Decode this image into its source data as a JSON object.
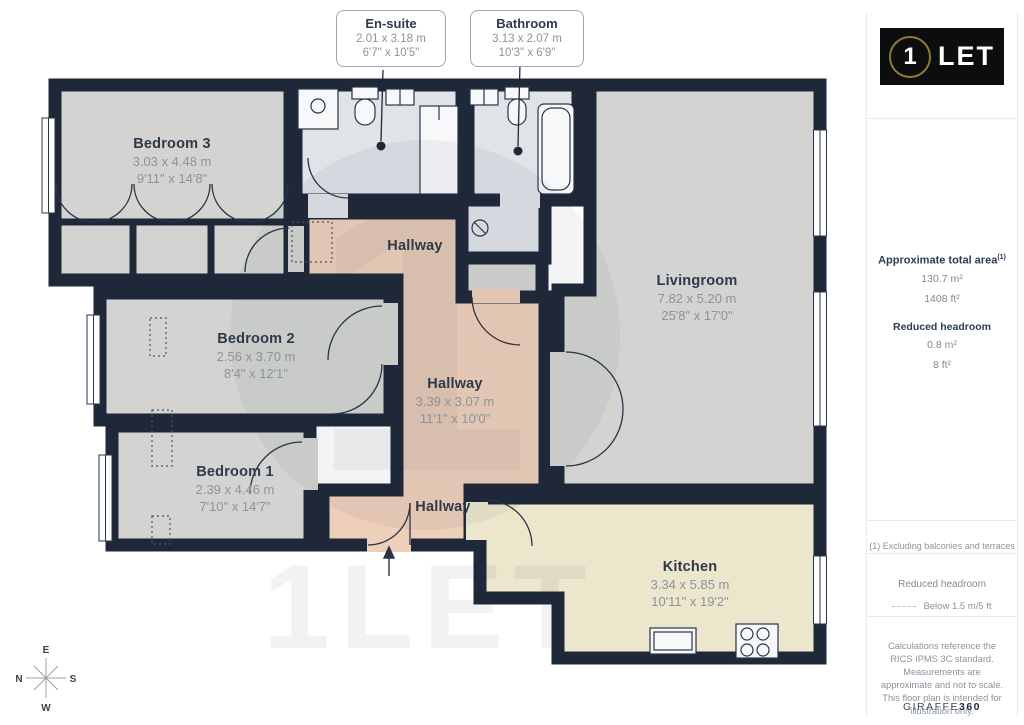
{
  "plan": {
    "callouts": {
      "ensuite": {
        "name": "En-suite",
        "dims_m": "2.01 x 3.18 m",
        "dims_ft": "6'7\" x 10'5\""
      },
      "bathroom": {
        "name": "Bathroom",
        "dims_m": "3.13 x 2.07 m",
        "dims_ft": "10'3\" x 6'9\""
      }
    },
    "rooms": {
      "bedroom3": {
        "name": "Bedroom 3",
        "dims_m": "3.03 x 4.48 m",
        "dims_ft": "9'11\" x 14'8\""
      },
      "bedroom2": {
        "name": "Bedroom 2",
        "dims_m": "2.56 x 3.70 m",
        "dims_ft": "8'4\" x 12'1\""
      },
      "bedroom1": {
        "name": "Bedroom 1",
        "dims_m": "2.39 x 4.46 m",
        "dims_ft": "7'10\" x 14'7\""
      },
      "livingroom": {
        "name": "Livingroom",
        "dims_m": "7.82 x 5.20 m",
        "dims_ft": "25'8\" x 17'0\""
      },
      "kitchen": {
        "name": "Kitchen",
        "dims_m": "3.34 x 5.85 m",
        "dims_ft": "10'11\" x 19'2\""
      },
      "hallway_center": {
        "name": "Hallway",
        "dims_m": "3.39 x 3.07 m",
        "dims_ft": "11'1\" x 10'0\""
      },
      "hallway_top": {
        "name": "Hallway"
      },
      "hallway_bottom": {
        "name": "Hallway"
      }
    },
    "compass": {
      "n": "N",
      "e": "E",
      "s": "S",
      "w": "W"
    },
    "watermark": {
      "glyph": "1",
      "text": "1LET"
    }
  },
  "sidebar": {
    "logo": {
      "number": "1",
      "text": "LET"
    },
    "area": {
      "title": "Approximate total area",
      "title_sup": "(1)",
      "m2": "130.7 m²",
      "ft2": "1408 ft²"
    },
    "headroom": {
      "title": "Reduced headroom",
      "m2": "0.8 m²",
      "ft2": "8 ft²"
    },
    "footnote": "(1) Excluding balconies and terraces",
    "legend": {
      "title": "Reduced headroom",
      "item": "Below 1.5 m/5 ft"
    },
    "disclaimer": "Calculations reference the RICS IPMS 3C standard. Measurements are approximate and not to scale. This floor plan is intended for illustration only.",
    "brand": {
      "normal": "GIRAFFE",
      "bold": "360"
    }
  },
  "colors": {
    "wall": "#1f2838",
    "bedroom_floor": "#d3d4d1",
    "bathroom_floor": "#e0e3e8",
    "hallway_floor": "#eecfba",
    "kitchen_floor": "#ece6cd",
    "logo_ring_gold": "#8f7c33",
    "logo_background": "#0c0d0f"
  }
}
